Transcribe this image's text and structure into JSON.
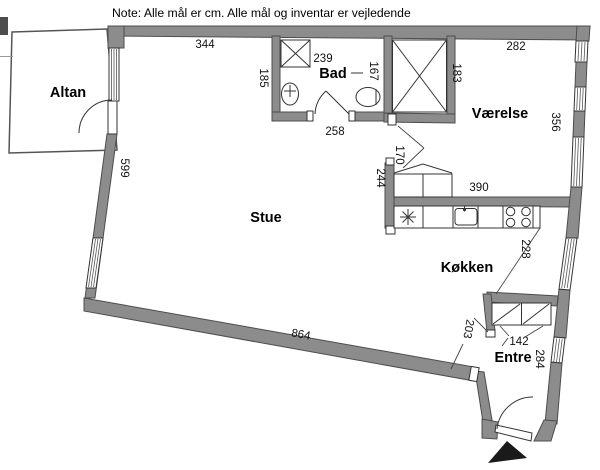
{
  "note": "Note: Alle mål er cm. Alle mål og inventar er vejledende",
  "rooms": {
    "altan": "Altan",
    "bad": "Bad",
    "vaerelse": "Værelse",
    "stue": "Stue",
    "koekken": "Køkken",
    "entre": "Entre"
  },
  "dims": {
    "stue_top": "344",
    "bad_top": "239",
    "bad_left": "185",
    "bad_mid": "167",
    "bad_door": "258",
    "closet_right": "183",
    "vaerelse_top": "282",
    "vaerelse_right": "356",
    "vaerelse_bottom": "390",
    "opening_stue_vaerelse": "170",
    "stue_koekken_wall": "244",
    "koekken_right": "228",
    "entre_wardrobe": "142",
    "entre_opening": "203",
    "entre_right": "284",
    "stue_left": "599",
    "stue_bottom": "864"
  },
  "colors": {
    "wall": "#8c8c8c",
    "wall_edge": "#4d4d4d",
    "line": "#333333",
    "background": "#ffffff",
    "entrance_arrow": "#1a1a1a"
  }
}
